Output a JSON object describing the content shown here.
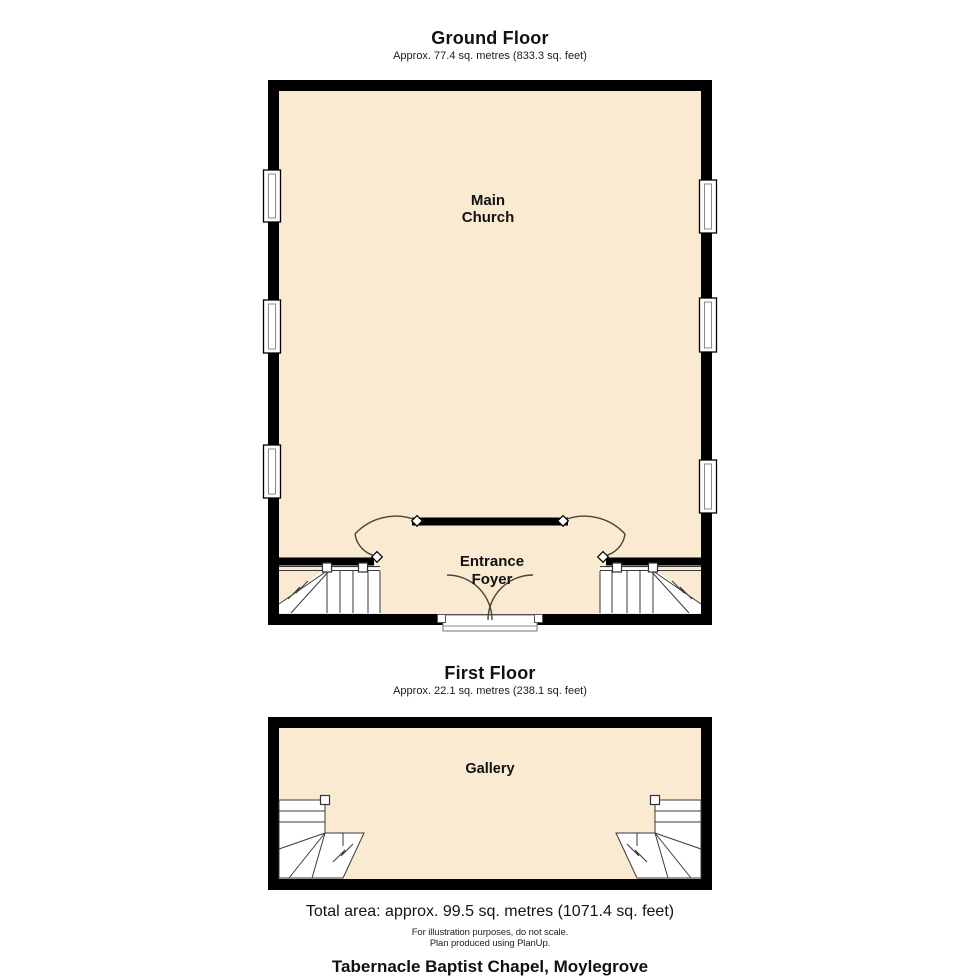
{
  "colors": {
    "floor_fill": "#FAEAD1",
    "wall": "#000000",
    "stair_line": "#3a3a3a",
    "door_arc": "#4a4436"
  },
  "ground_floor": {
    "title": "Ground Floor",
    "area": "Approx. 77.4 sq. metres (833.3 sq. feet)",
    "rooms": {
      "main_church": {
        "line1": "Main",
        "line2": "Church"
      },
      "entrance_foyer": {
        "line1": "Entrance",
        "line2": "Foyer"
      }
    }
  },
  "first_floor": {
    "title": "First Floor",
    "area": "Approx. 22.1 sq. metres (238.1 sq. feet)",
    "rooms": {
      "gallery": {
        "label": "Gallery"
      }
    }
  },
  "footer": {
    "total_area": "Total area: approx. 99.5 sq. metres (1071.4 sq. feet)",
    "disclaimer_line1": "For illustration purposes, do not scale.",
    "disclaimer_line2": "Plan produced using PlanUp.",
    "property_name": "Tabernacle Baptist Chapel, Moylegrove"
  }
}
